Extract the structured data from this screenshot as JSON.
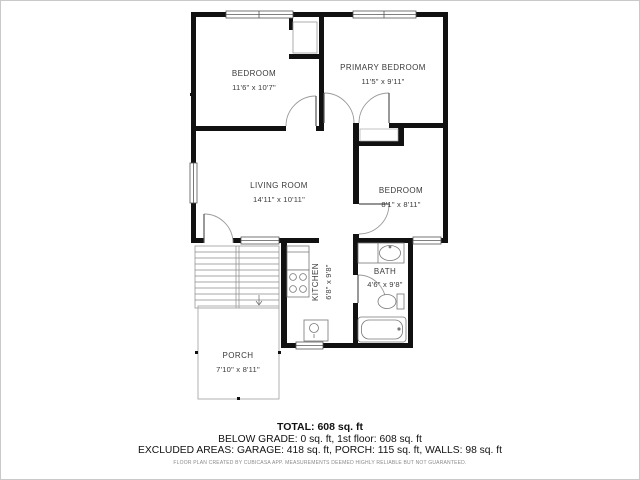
{
  "plan": {
    "rooms": {
      "bedroom1": {
        "name": "BEDROOM",
        "dims": "11'6\" x 10'7\""
      },
      "primary_bedroom": {
        "name": "PRIMARY BEDROOM",
        "dims": "11'5\" x 9'11\""
      },
      "living_room": {
        "name": "LIVING ROOM",
        "dims": "14'11\" x 10'11\""
      },
      "bedroom3": {
        "name": "BEDROOM",
        "dims": "8'1\" x 8'11\""
      },
      "kitchen": {
        "name": "KITCHEN",
        "dims": "6'8\" x 9'8\""
      },
      "bath": {
        "name": "BATH",
        "dims": "4'6\" x 9'8\""
      },
      "porch": {
        "name": "PORCH",
        "dims": "7'10\" x 8'11\""
      }
    },
    "colors": {
      "wall": "#111111",
      "door_arc": "#9a9a9a",
      "fixture": "#777777",
      "label": "#3a3a3a"
    }
  },
  "summary": {
    "total": "TOTAL: 608 sq. ft",
    "below_grade": "BELOW GRADE: 0 sq. ft, 1st floor: 608 sq. ft",
    "excluded": "EXCLUDED AREAS: GARAGE: 418 sq. ft, PORCH: 115 sq. ft, WALLS: 98 sq. ft",
    "disclaimer": "FLOOR PLAN CREATED BY CUBICASA APP. MEASUREMENTS DEEMED HIGHLY RELIABLE BUT NOT GUARANTEED."
  }
}
